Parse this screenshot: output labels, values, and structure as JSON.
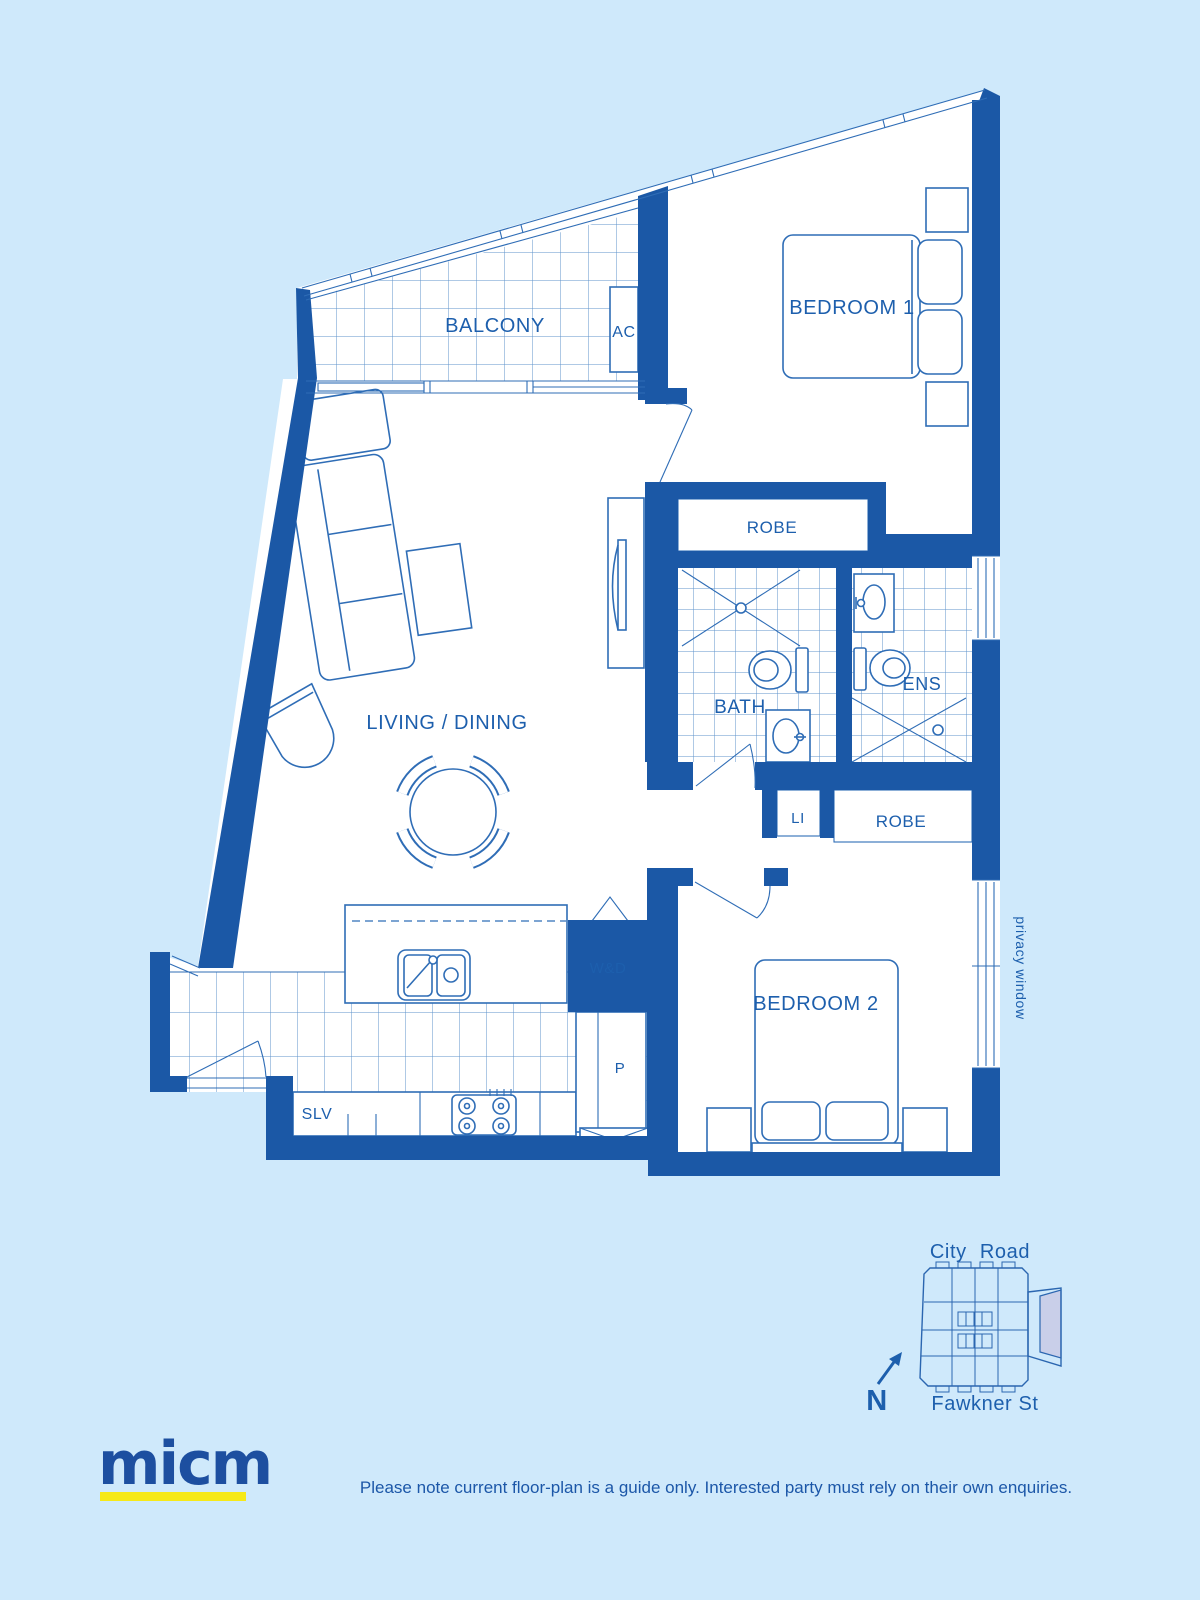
{
  "colors": {
    "background": "#cfe9fb",
    "wall": "#1b58a6",
    "line": "#2f6db6",
    "tile_grid": "#5f93cb",
    "label": "#1d5fad",
    "logo": "#1d4fa0",
    "logo_underline": "#f6e918",
    "key_plan_unit_highlight": "#c9cfe9"
  },
  "plan": {
    "labels": {
      "balcony": "BALCONY",
      "ac": "AC",
      "bedroom1": "BEDROOM 1",
      "robe1": "ROBE",
      "bath": "BATH",
      "ens": "ENS",
      "linen": "LI",
      "robe2": "ROBE",
      "living": "LIVING / DINING",
      "washer_dryer": "W&D",
      "pantry": "P",
      "shelves": "SLV",
      "bedroom2": "BEDROOM 2",
      "privacy_window": "privacy window"
    }
  },
  "key_plan": {
    "street_top": "City Road",
    "street_bottom": "Fawkner St",
    "north": "N"
  },
  "footer": {
    "logo": "micm",
    "disclaimer": "Please note current floor-plan is a guide only. Interested party must rely on their own enquiries."
  }
}
